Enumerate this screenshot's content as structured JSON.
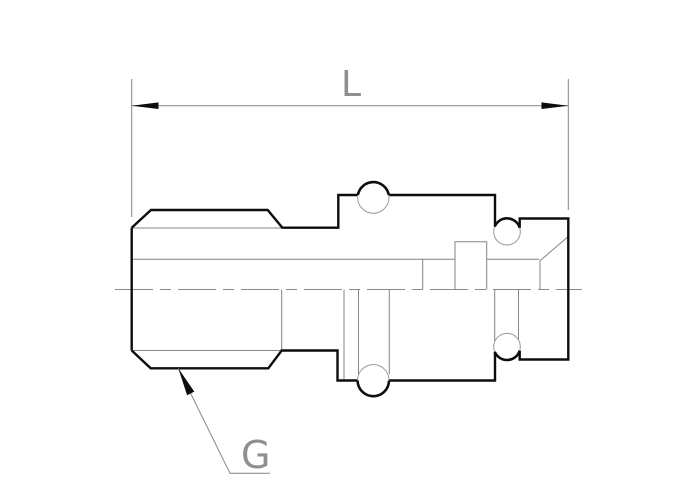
{
  "drawing": {
    "type": "engineering-drawing",
    "subject": "threaded-fitting-side-view",
    "labels": {
      "length_dimension": "L",
      "thread_designation": "G"
    },
    "colors": {
      "background": "#ffffff",
      "outline": "#0d0d0d",
      "thin_line": "#848484",
      "centerline": "#8a8a8a",
      "label_text": "#8f8f8f",
      "arrowhead": "#0d0d0d"
    }
  }
}
